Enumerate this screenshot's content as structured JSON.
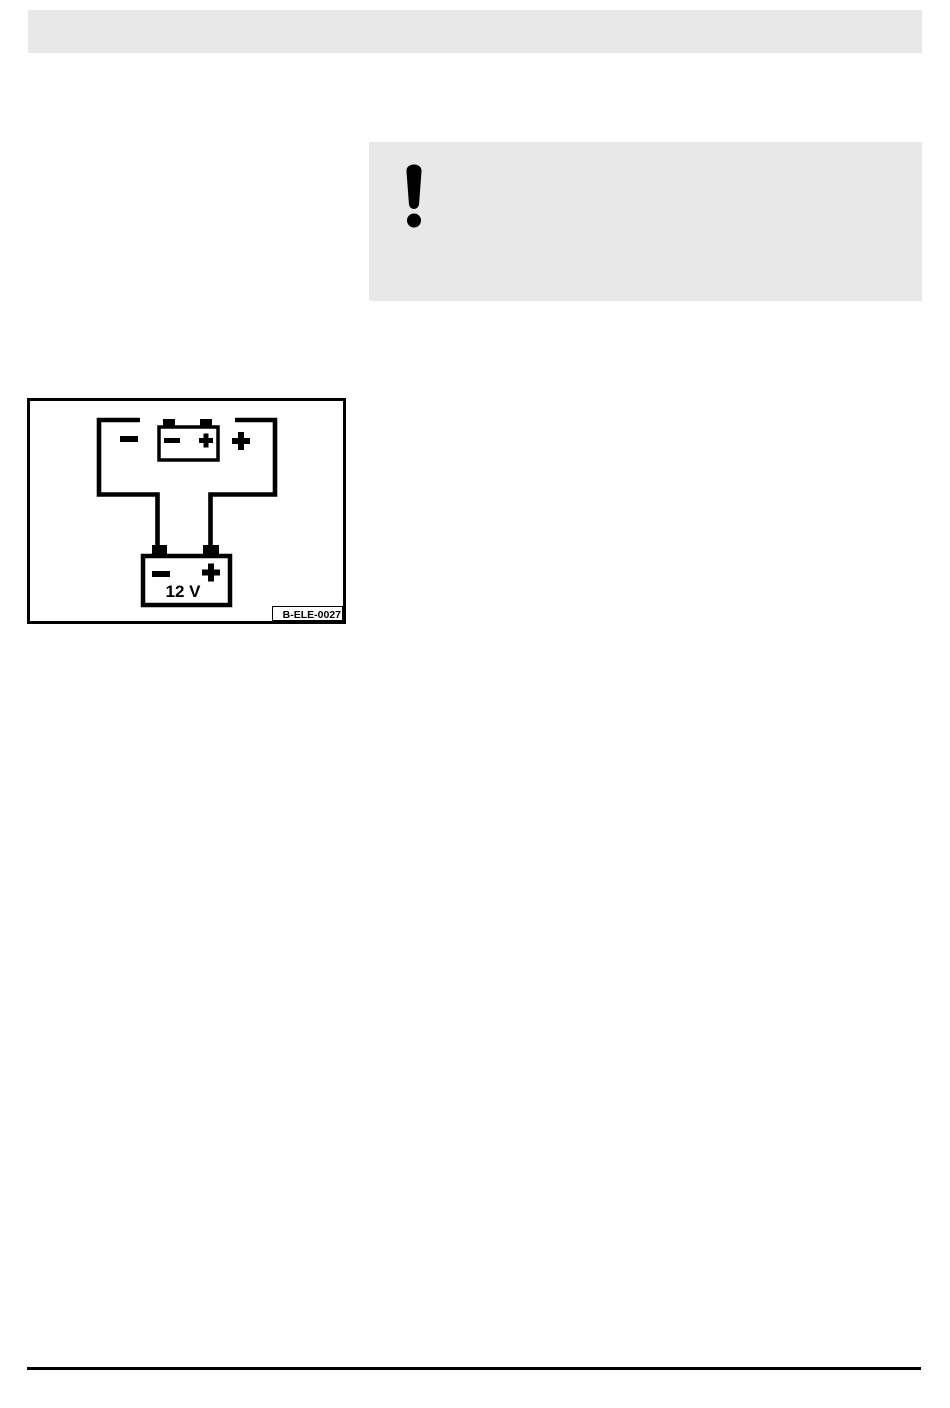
{
  "colors": {
    "panel_gray": "#e8e8e8",
    "ink": "#000000",
    "paper": "#ffffff"
  },
  "warning_callout": {
    "icon": "exclamation-icon"
  },
  "figure": {
    "code_label": "B-ELE-0027",
    "battery_voltage": "12 V",
    "terminals": {
      "charger_left": "−",
      "charger_right": "+",
      "charger_battery_left": "−",
      "charger_battery_right": "+",
      "battery_left": "−",
      "battery_right": "+"
    }
  }
}
